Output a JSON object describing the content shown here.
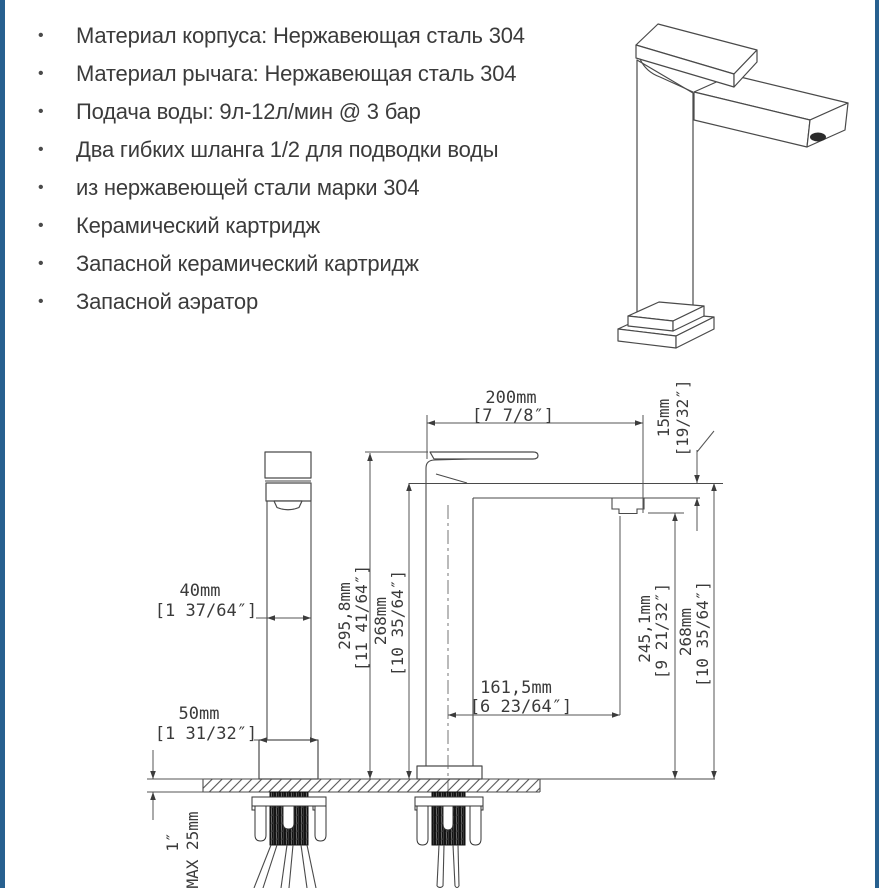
{
  "features": {
    "items": [
      "Материал корпуса: Нержавеющая сталь 304",
      "Материал рычага: Нержавеющая сталь 304",
      "Подача воды: 9л-12л/мин @ 3 бар",
      "Два гибких шланга 1/2 для подводки воды",
      "из нержавеющей стали марки 304",
      "Керамический картридж",
      "Запасной керамический картридж",
      "Запасной аэратор"
    ]
  },
  "drawing": {
    "d200": {
      "mm": "200mm",
      "in": "[7 7/8″]"
    },
    "d15": {
      "mm": "15mm",
      "in": "[19/32″]"
    },
    "d40": {
      "mm": "40mm",
      "in": "[1 37/64″]"
    },
    "d295": {
      "mm": "295,8mm",
      "in": "[11 41/64″]"
    },
    "d268l": {
      "mm": "268mm",
      "in": "[10 35/64″]"
    },
    "d161": {
      "mm": "161,5mm",
      "in": "[6 23/64″]"
    },
    "d245": {
      "mm": "245,1mm",
      "in": "[9 21/32″]"
    },
    "d268r": {
      "mm": "268mm",
      "in": "[10 35/64″]"
    },
    "d50": {
      "mm": "50mm",
      "in": "[1 31/32″]"
    },
    "d25": {
      "max": "MAX 25mm",
      "in": "1″"
    }
  },
  "colors": {
    "accent_border": "#27608f",
    "text": "#3b3b3b"
  }
}
